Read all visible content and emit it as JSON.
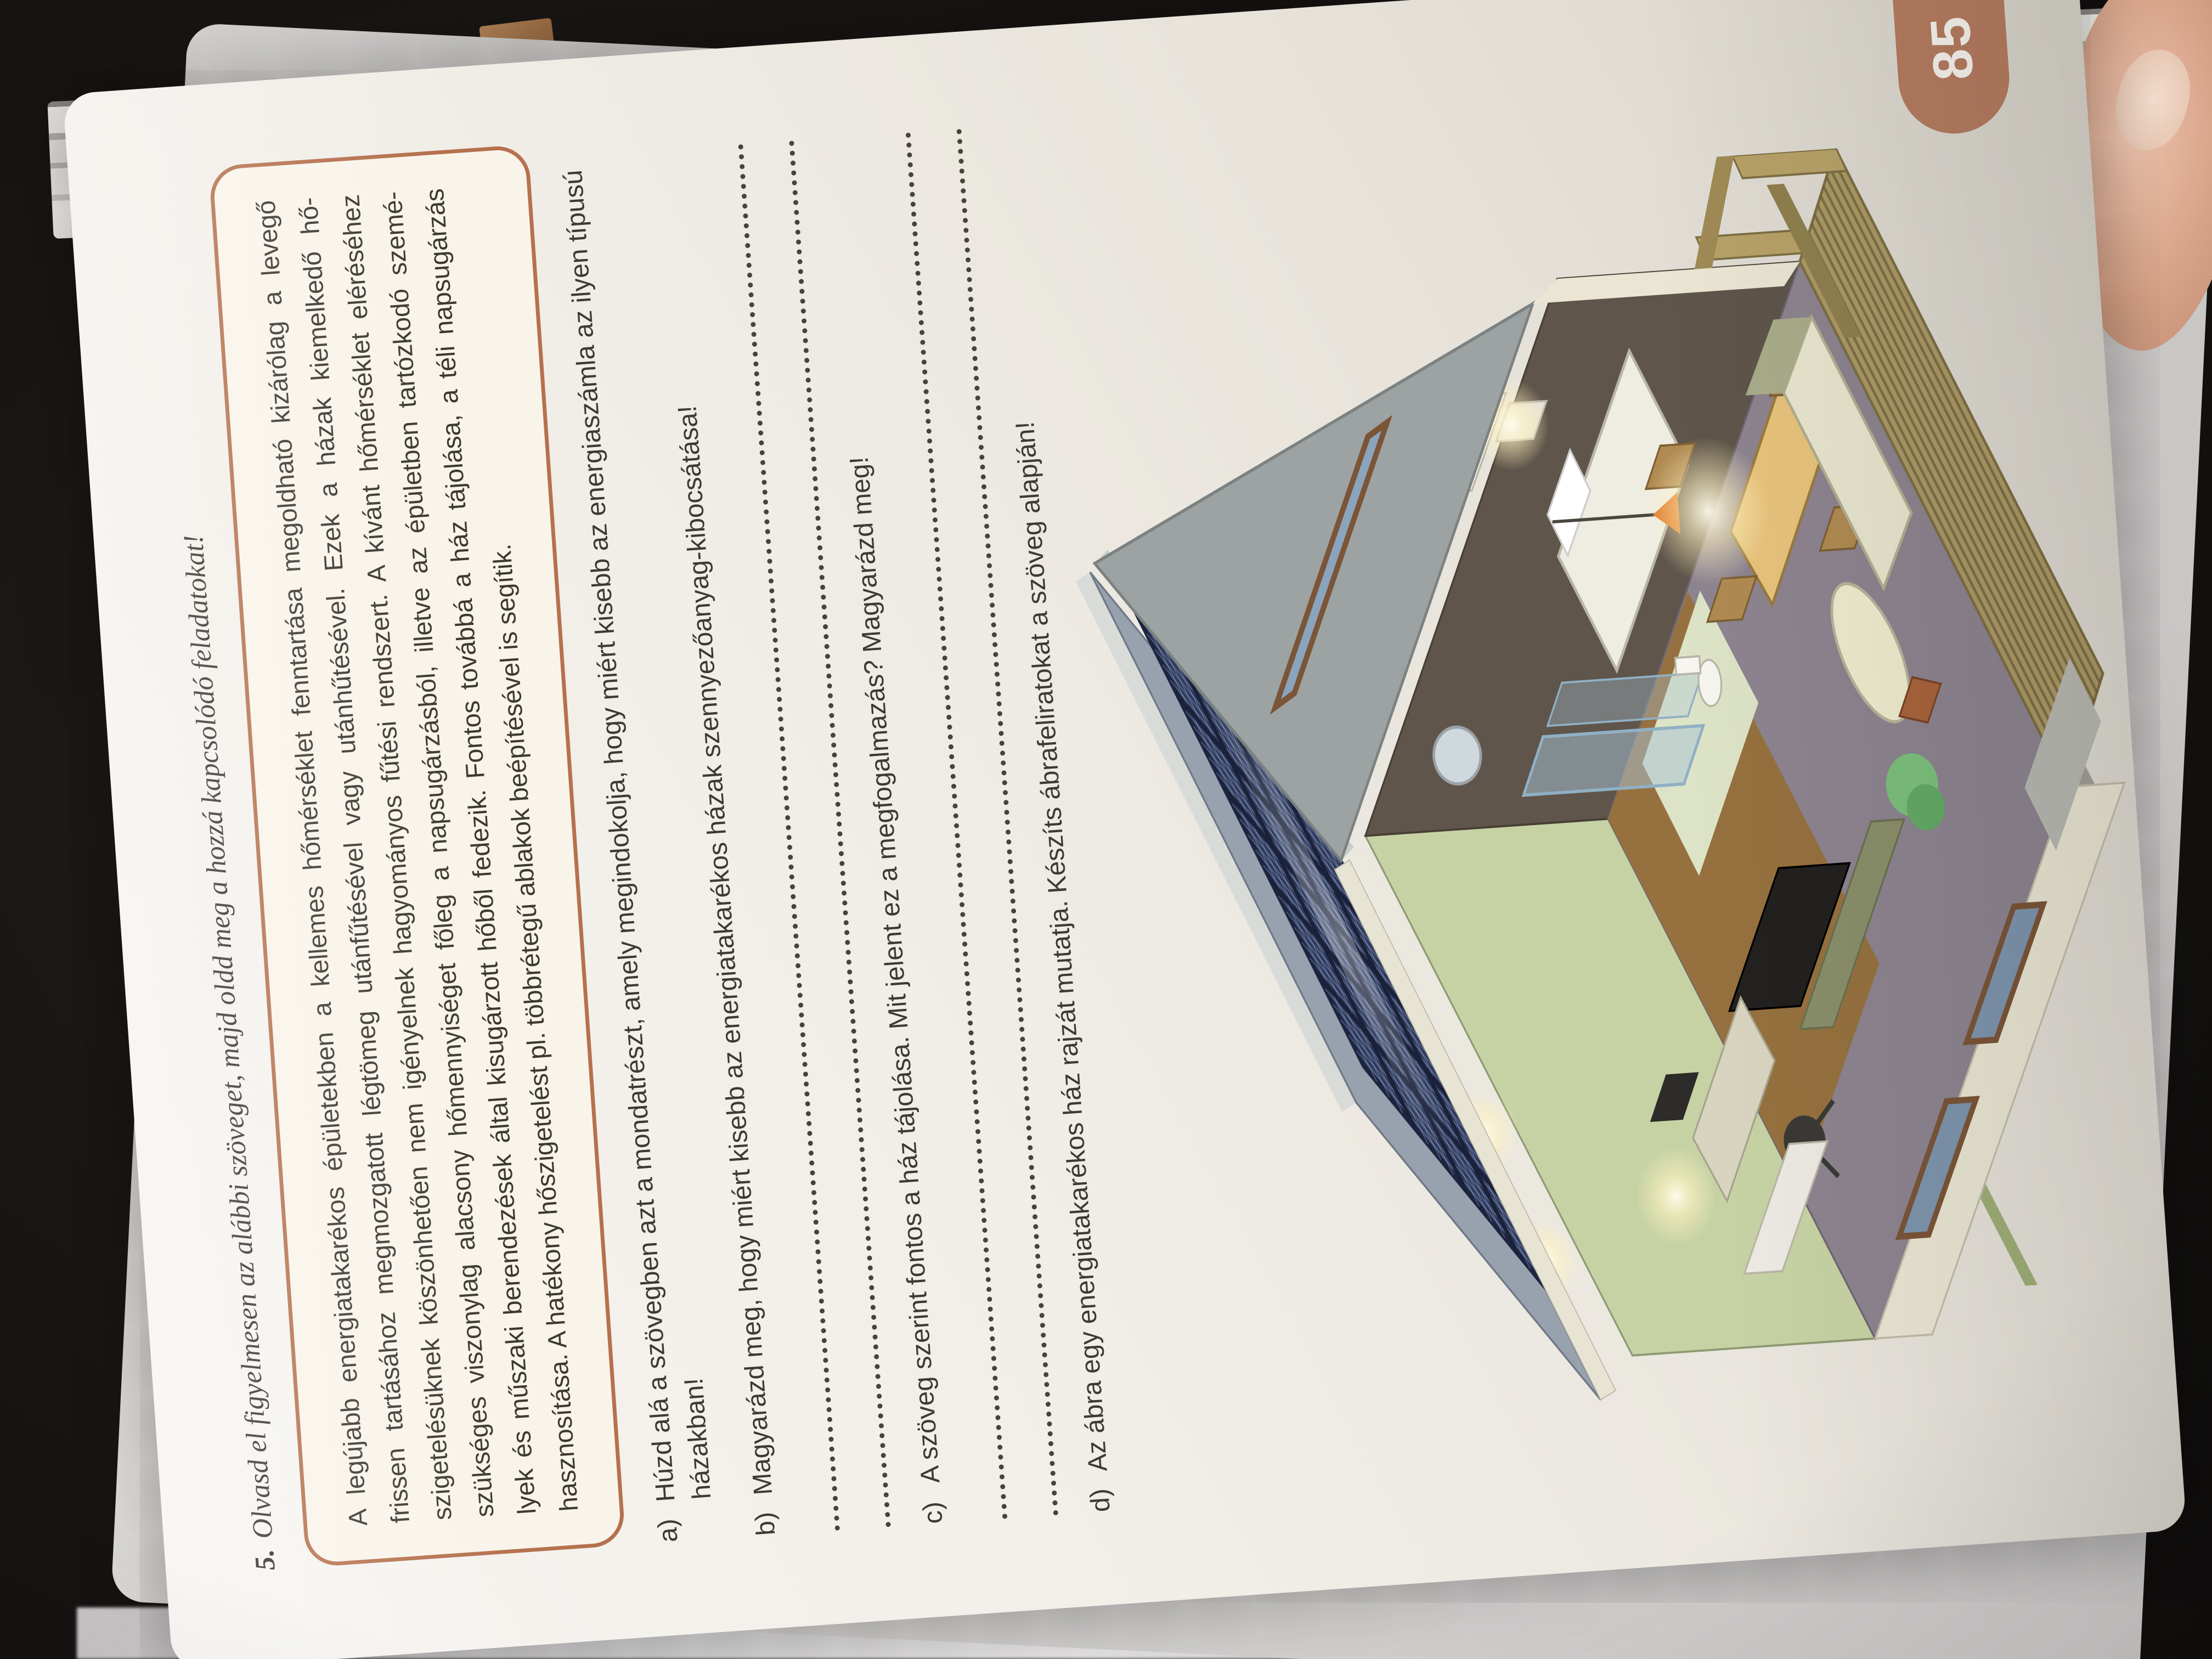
{
  "page": {
    "page_number": "85",
    "task_number": "5.",
    "task_title": "Olvasd el figyelmesen az alábbi szöveget, majd oldd meg a hozzá kapcsolódó feladatokat!",
    "info_box": {
      "lines": [
        "A legújabb energiatakarékos épületekben a kellemes hőmérséklet fenntartása megoldható kizárólag a levegő",
        "frissen tartásához megmozgatott légtömeg utánfűtésével vagy utánhűtésével. Ezek a házak kiemelkedő hő-",
        "szigetelésüknek köszönhetően nem igényelnek hagyományos fűtési rendszert. A kívánt hőmérséklet eléréséhez",
        "szükséges viszonylag alacsony hőmennyiséget főleg a napsugárzásból, illetve az épületben tartózkodó szemé-",
        "lyek és műszaki berendezések által kisugárzott hőből fedezik. Fontos továbbá a ház tájolása, a téli napsugárzás",
        "hasznosítása. A hatékony hőszigetelést pl. többrétegű ablakok beépítésével is segítik."
      ],
      "full_text": "A legújabb energiatakarékos épületekben a kellemes hőmérséklet fenntartása megoldható kizárólag a levegő frissen tartásához megmozgatott légtömeg utánfűtésével vagy utánhűtésével. Ezek a házak kiemelkedő hőszigetelésüknek köszönhetően nem igényelnek hagyományos fűtési rendszert. A kívánt hőmérséklet eléréséhez szükséges viszonylag alacsony hőmennyiséget főleg a napsugárzásból, illetve az épületben tartózkodó személyek és műszaki berendezések által kisugárzott hőből fedezik. Fontos továbbá a ház tájolása, a téli napsugárzás hasznosítása. A hatékony hőszigetelést pl. többrétegű ablakok beépítésével is segítik."
    },
    "questions": [
      {
        "label": "a)",
        "text": "Húzd alá a szövegben azt a mondatrészt, amely megindokolja, hogy miért kisebb az energiaszámla az ilyen típusú házakban!",
        "answer_lines": 0
      },
      {
        "label": "b)",
        "text": "Magyarázd meg, hogy miért kisebb az energiatakarékos házak szennyezőanyag-kibocsátása!",
        "answer_lines": 2
      },
      {
        "label": "c)",
        "text": "A szöveg szerint fontos a ház tájolása. Mit jelent ez a megfogalmazás? Magyarázd meg!",
        "answer_lines": 2
      },
      {
        "label": "d)",
        "text": "Az ábra egy energiatakarékos ház rajzát mutatja. Készíts ábrafeliratokat a szöveg alapján!",
        "answer_lines": 0
      }
    ],
    "underpage_fragment": "ta"
  },
  "illustration": {
    "name": "energy-efficient-house-cutaway",
    "description": "Isometric cutaway drawing of an energy-efficient house: rooftop solar panel array, gable with slot window, interior rooms (bedroom, bathroom with glass shower, study desk with computer, living room with sofa, TV and dining table with glowing lamp) and a wooden terrace",
    "colors": {
      "solar_panel": "#2e3b5e",
      "roof": "#98a2ae",
      "gable": "#9da3a2",
      "wall_cream": "#eae6d3",
      "interior_green": "#c7d2a4",
      "bedroom_brown": "#5f554a",
      "living_floor": "#8d8490",
      "terrace_wood": "#ac9a66",
      "window_glass": "#7e95ad",
      "lamp_glow": "#ffe9a0",
      "box_border": "#b5714e",
      "page_tab": "#b57c60"
    }
  }
}
